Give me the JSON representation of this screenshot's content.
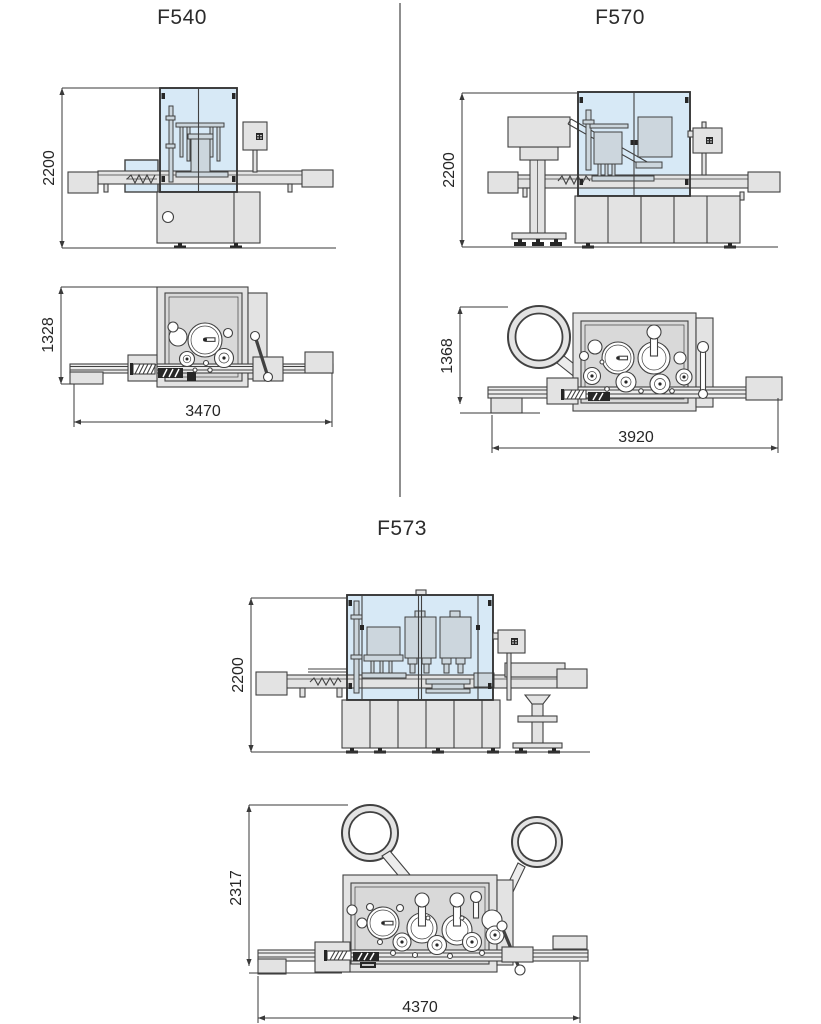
{
  "page": {
    "background": "#ffffff"
  },
  "colors": {
    "line": "#414141",
    "machine_gray": "#e3e3e3",
    "internals_gray": "#ccd6dd",
    "glass_blue": "#d7e9f6",
    "plan_interior": "#d9d9d9",
    "divider_gray": "#8f8f8f",
    "text": "#2b2b2b"
  },
  "machines": [
    {
      "model": "F540",
      "side_view": {
        "height": "2200"
      },
      "top_view": {
        "depth": "1328",
        "length": "3470"
      }
    },
    {
      "model": "F570",
      "side_view": {
        "height": "2200"
      },
      "top_view": {
        "depth": "1368",
        "length": "3920"
      }
    },
    {
      "model": "F573",
      "side_view": {
        "height": "2200"
      },
      "top_view": {
        "depth": "2317",
        "length": "4370"
      }
    }
  ]
}
